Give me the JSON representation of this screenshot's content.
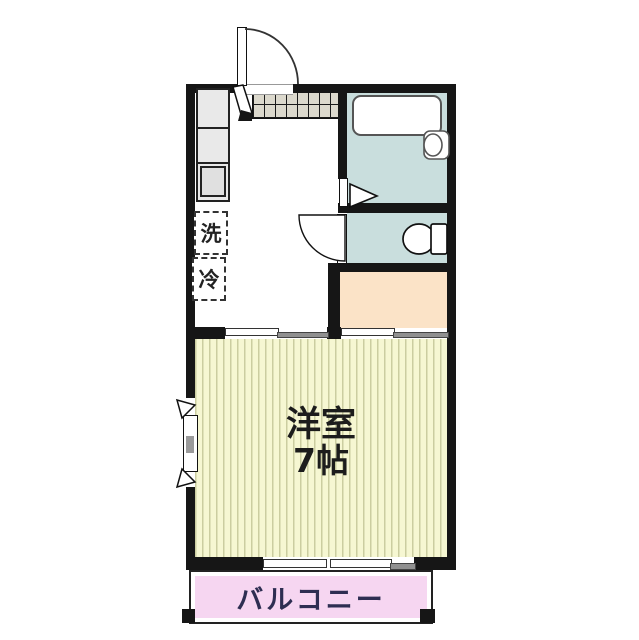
{
  "plan": {
    "type": "japanese-apartment-floor-plan",
    "rooms": {
      "main_room": {
        "name": "洋室",
        "size": "7帖"
      },
      "balcony": {
        "label": "バルコニー"
      },
      "kitchen": {
        "washer_label": "洗",
        "fridge_label": "冷"
      }
    },
    "fixtures": [
      "entrance-door",
      "entrance-tile-floor",
      "kitchen-counter",
      "kitchen-sink",
      "washing-machine-space",
      "refrigerator-space",
      "bathtub",
      "bathroom-sink",
      "bathroom-folding-door",
      "toilet",
      "toilet-door",
      "closet",
      "window",
      "sliding-doors",
      "balcony-sliding-door"
    ],
    "colors": {
      "wall": "#161616",
      "bathroom_floor": "#c9dedd",
      "toilet_floor": "#c9dedd",
      "closet": "#fbe3c7",
      "main_room_floor": "#f6f7d2",
      "floor_stripe": "#cbcda0",
      "balcony": "#f6d6f1",
      "balcony_text": "#2e2e52",
      "entrance_tile": "#dcd9cd",
      "counter": "#e9e9e9"
    }
  }
}
